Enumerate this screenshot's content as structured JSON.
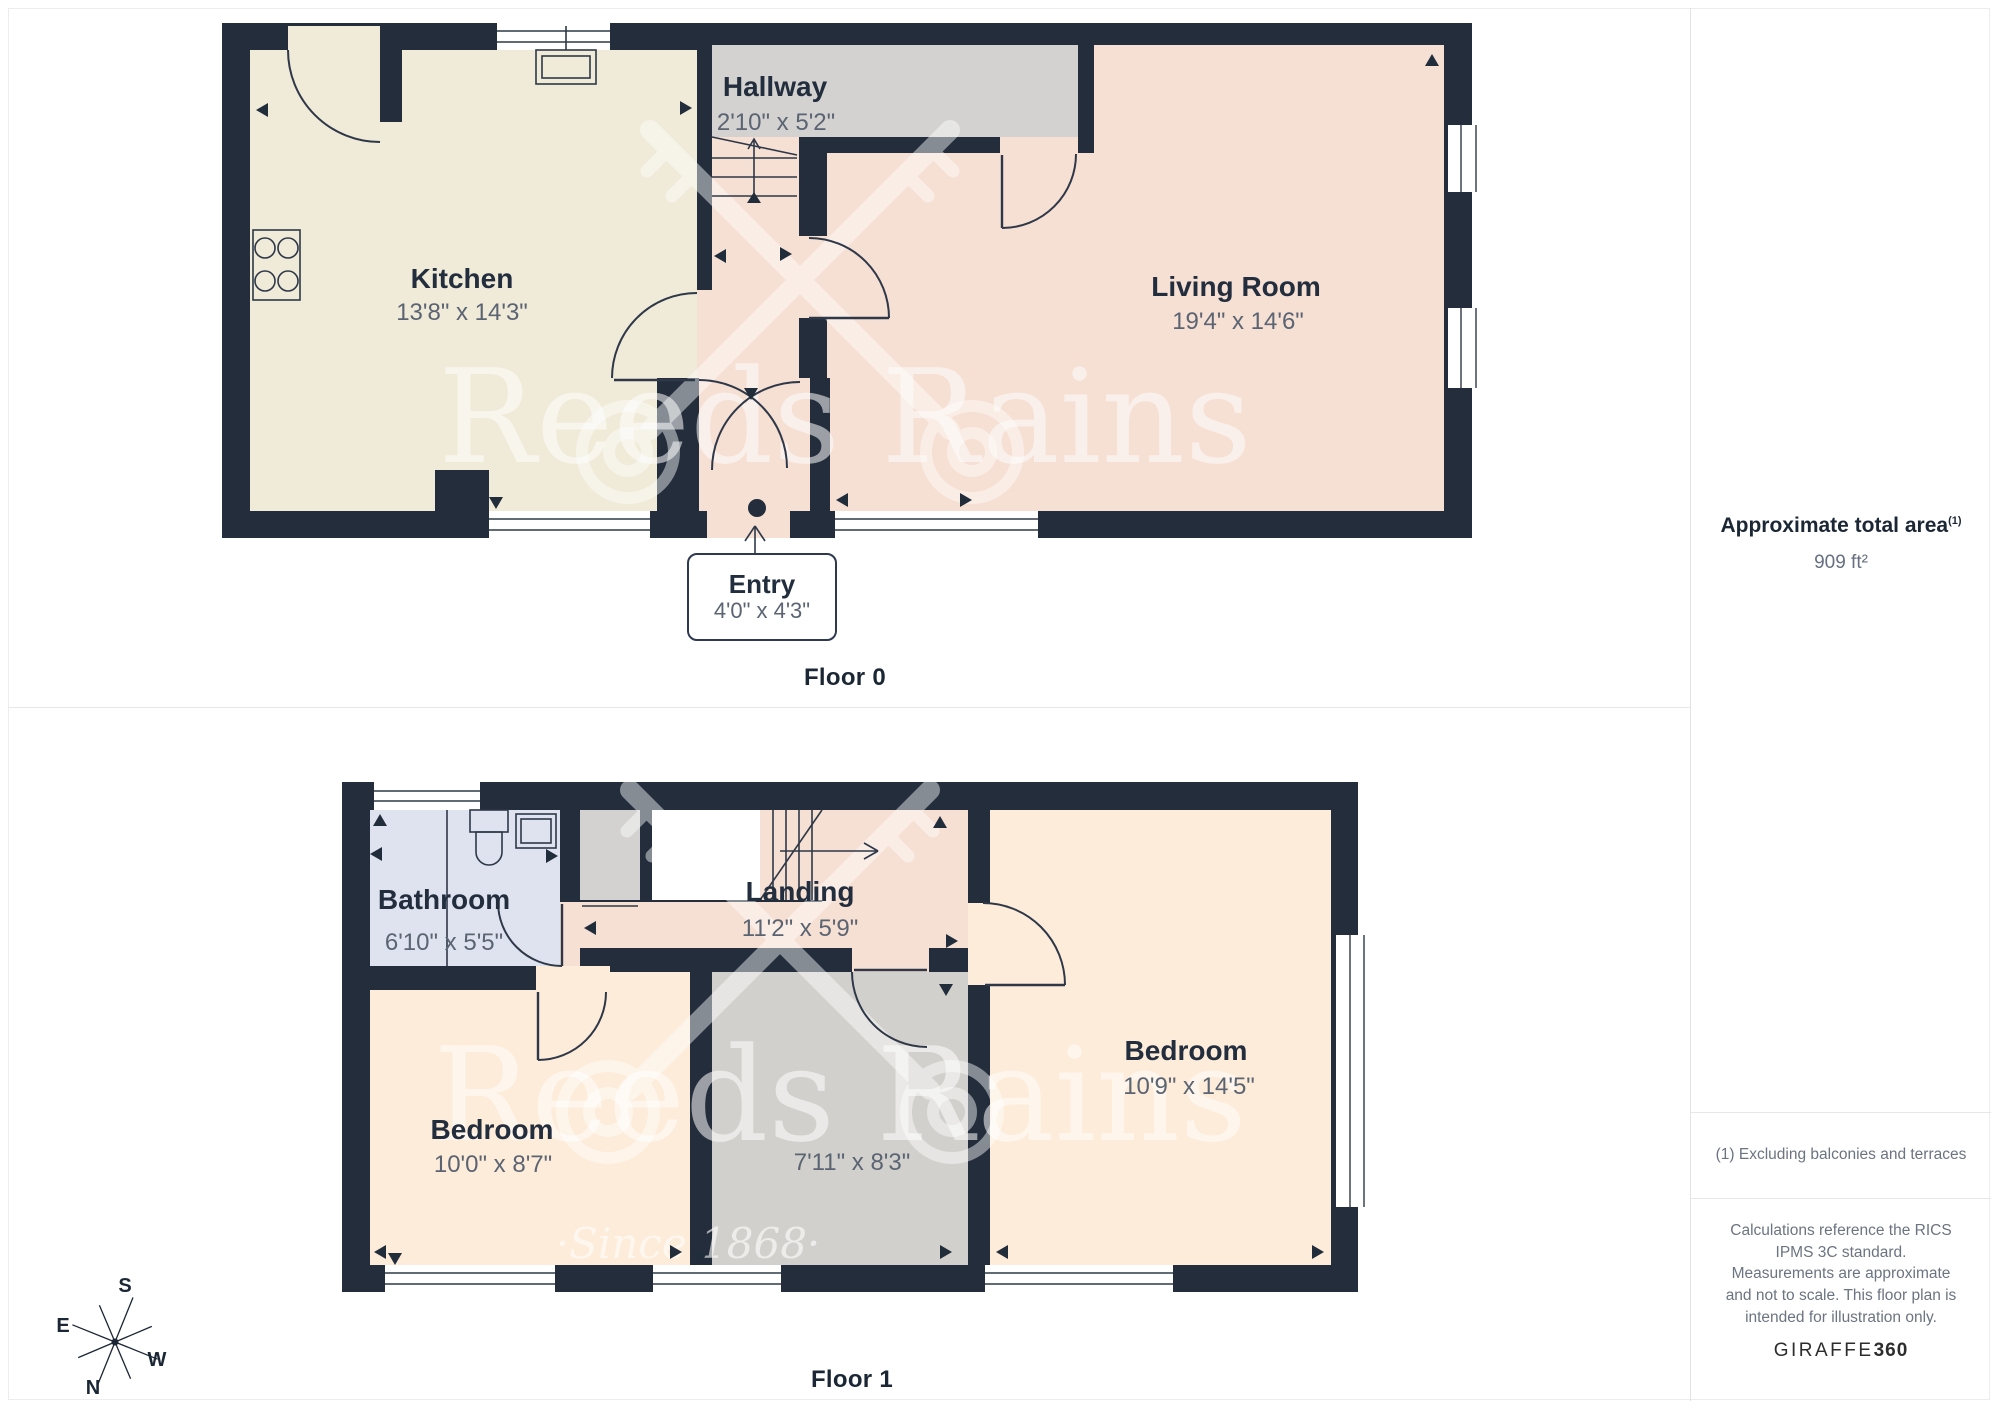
{
  "colors": {
    "wall": "#232d3b",
    "kitchen_floor": "#f0ead8",
    "living_floor": "#f6dfd3",
    "hallway_floor": "#d3d2d0",
    "bathroom_floor": "#dfe3ef",
    "bedroom_floor": "#fdecd9",
    "center_room_floor": "#d2d0cc",
    "label_text": "#222d3d",
    "dims_text": "#5b6472"
  },
  "floor0": {
    "caption": "Floor 0",
    "kitchen": {
      "name": "Kitchen",
      "dims": "13'8\" x 14'3\""
    },
    "hallway": {
      "name": "Hallway",
      "dims": "2'10\" x 5'2\""
    },
    "living_room": {
      "name": "Living Room",
      "dims": "19'4\" x 14'6\""
    },
    "entry": {
      "name": "Entry",
      "dims": "4'0\" x 4'3\""
    }
  },
  "floor1": {
    "caption": "Floor 1",
    "bathroom": {
      "name": "Bathroom",
      "dims": "6'10\" x 5'5\""
    },
    "landing": {
      "name": "Landing",
      "dims": "11'2\" x 5'9\""
    },
    "bedroom_left": {
      "name": "Bedroom",
      "dims": "10'0\" x 8'7\""
    },
    "center_room": {
      "dims": "7'11\" x 8'3\""
    },
    "bedroom_right": {
      "name": "Bedroom",
      "dims": "10'9\" x 14'5\""
    }
  },
  "sidebar": {
    "area_title": "Approximate total area",
    "area_sup": "(1)",
    "area_value": "909 ft²",
    "footnote": "(1) Excluding balconies and terraces",
    "disclaimer": "Calculations reference the RICS IPMS 3C standard. Measurements are approximate and not to scale. This floor plan is intended for illustration only.",
    "brand": "GIRAFFE",
    "brand_suffix": "360"
  },
  "watermark": {
    "text": "Reeds Rains",
    "tagline": "·Since 1868·"
  },
  "compass": {
    "n": "N",
    "e": "E",
    "s": "S",
    "w": "W"
  }
}
